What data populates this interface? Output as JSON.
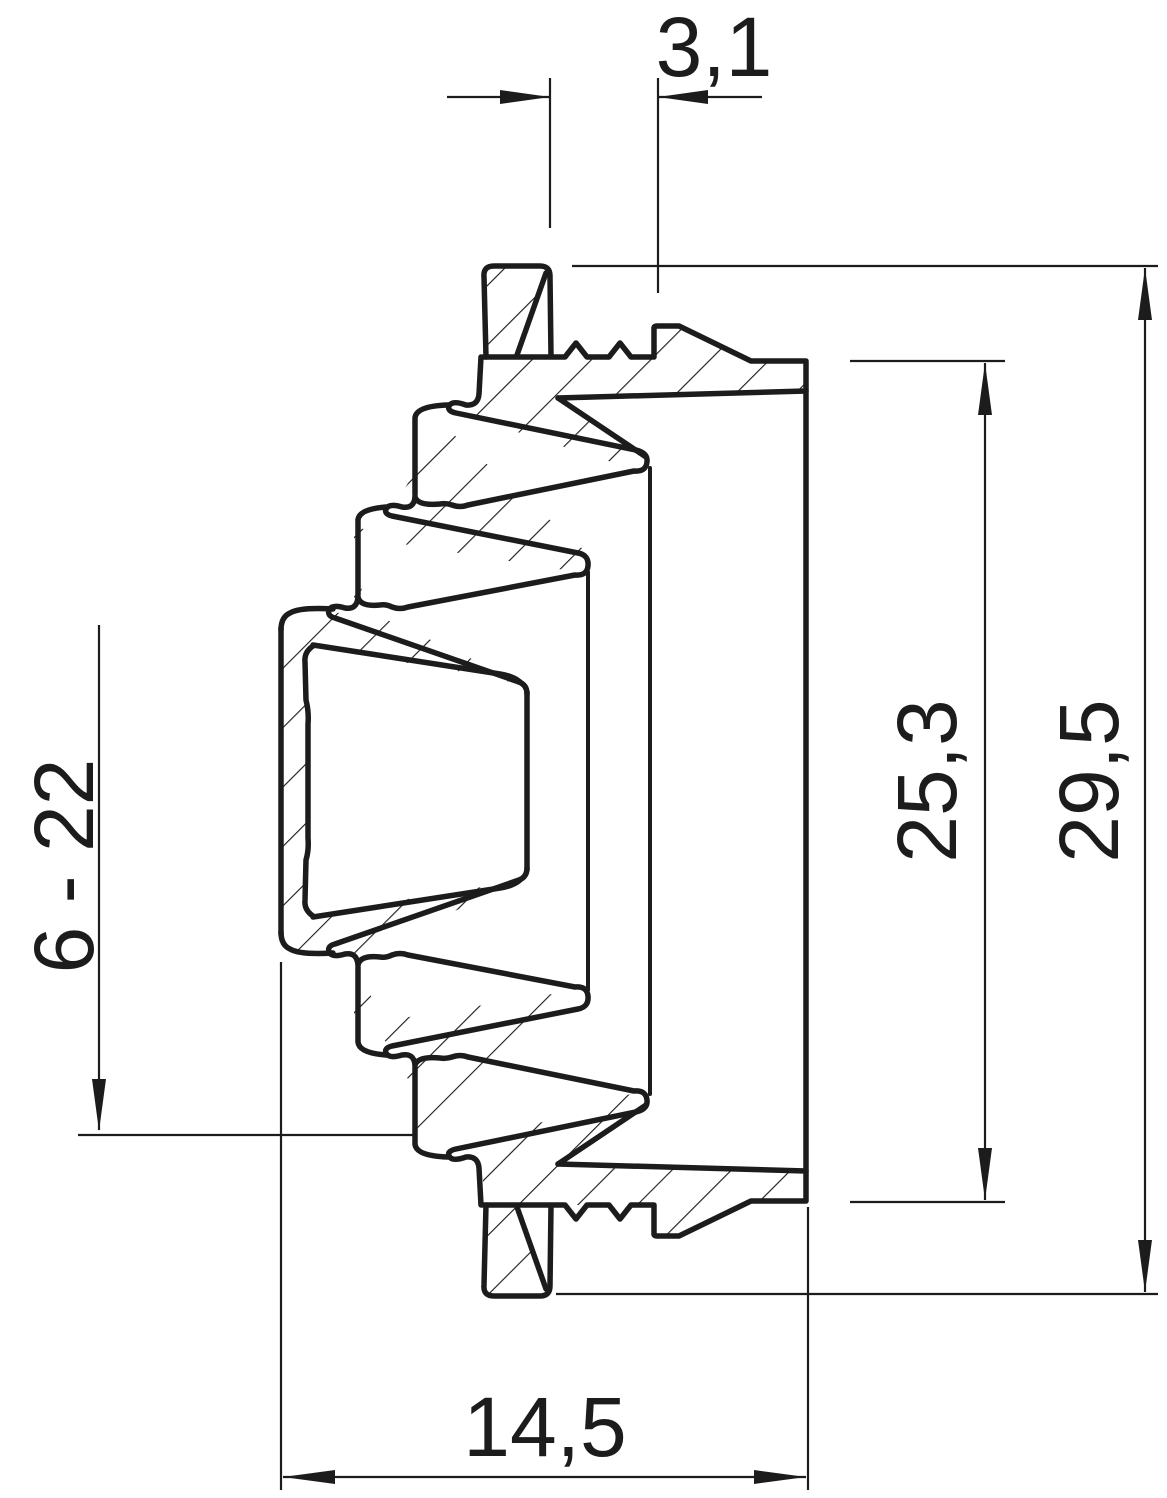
{
  "drawing": {
    "type": "technical-cross-section",
    "subject": "stepped cable entry grommet, sectional side view",
    "line_color": "#1c1c1c",
    "background_color": "#ffffff",
    "hatch_angle_deg": 45,
    "dimensions": {
      "top_width": {
        "value": "3,1",
        "orientation": "horizontal",
        "position": "top"
      },
      "inner_height": {
        "value": "25,3",
        "orientation": "vertical",
        "position": "right-inner"
      },
      "outer_height": {
        "value": "29,5",
        "orientation": "vertical",
        "position": "right-outer"
      },
      "clamping_range": {
        "value": "6 - 22",
        "orientation": "vertical",
        "position": "left"
      },
      "bottom_width": {
        "value": "14,5",
        "orientation": "horizontal",
        "position": "bottom"
      }
    }
  }
}
